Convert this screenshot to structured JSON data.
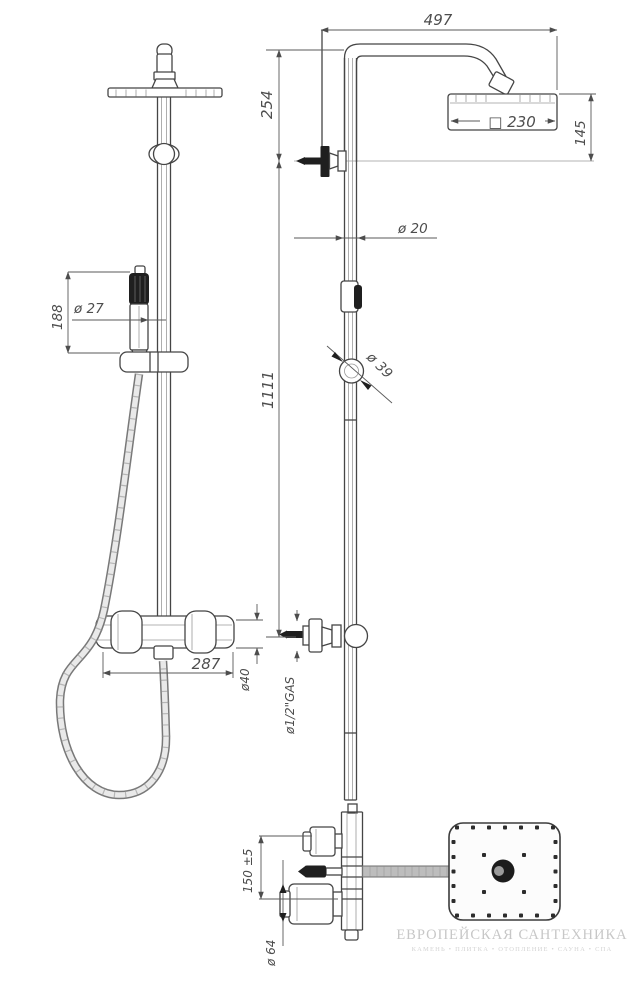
{
  "dims": {
    "top_width": "497",
    "head_offset": "254",
    "head_size": "□ 230",
    "head_depth": "145",
    "pipe_diameter": "ø 20",
    "handshower_diameter": "ø 27",
    "handshower_length": "188",
    "column_height": "1111",
    "slider_diameter": "ø 39",
    "mixer_width": "287",
    "mixer_body_diameter": "ø40",
    "inlet_thread": "ø1/2\"GAS",
    "inlet_spacing": "150 ±5",
    "handle_diameter": "ø 64"
  },
  "watermark": {
    "title": "ЕВРОПЕЙСКАЯ САНТЕХНИКА",
    "subtitle": "КАМЕНЬ • ПЛИТКА • ОТОПЛЕНИЕ • САУНА • СПА"
  },
  "colors": {
    "line": "#454545",
    "dimension_text": "#4d4d4d",
    "hose_gray": "#a7a7a7",
    "watermark": "#c7c7c7",
    "background": "#ffffff"
  }
}
